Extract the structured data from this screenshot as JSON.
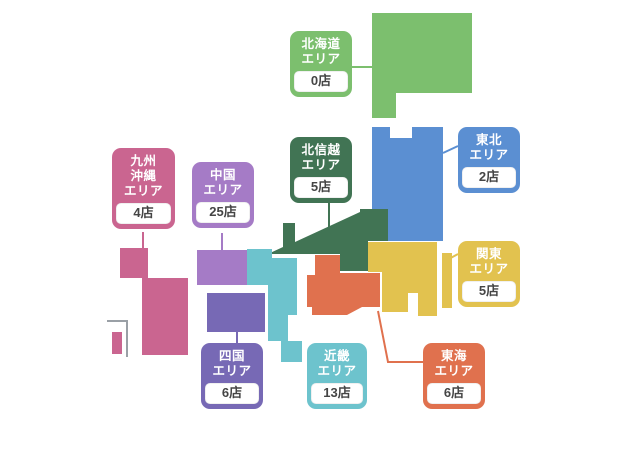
{
  "regions": {
    "hokkaido": {
      "name": "北海道\nエリア",
      "count": "0店",
      "color": "#7cbf6e"
    },
    "tohoku": {
      "name": "東北\nエリア",
      "count": "2店",
      "color": "#5b8fd2"
    },
    "hokushinetsu": {
      "name": "北信越\nエリア",
      "count": "5店",
      "color": "#417454"
    },
    "kanto": {
      "name": "関東\nエリア",
      "count": "5店",
      "color": "#e2c24f"
    },
    "tokai": {
      "name": "東海\nエリア",
      "count": "6店",
      "color": "#e0714e"
    },
    "kinki": {
      "name": "近畿\nエリア",
      "count": "13店",
      "color": "#6dc3cd"
    },
    "shikoku": {
      "name": "四国\nエリア",
      "count": "6店",
      "color": "#7769b5"
    },
    "chugoku": {
      "name": "中国\nエリア",
      "count": "25店",
      "color": "#a57bc6"
    },
    "kyushu": {
      "name": "九州\n沖縄\nエリア",
      "count": "4店",
      "color": "#ca6590"
    }
  },
  "okinawa_inset": {
    "bracket_color": "#9aa0a6"
  },
  "canvas": {
    "background": "#ffffff",
    "count_text_color": "#454545"
  }
}
